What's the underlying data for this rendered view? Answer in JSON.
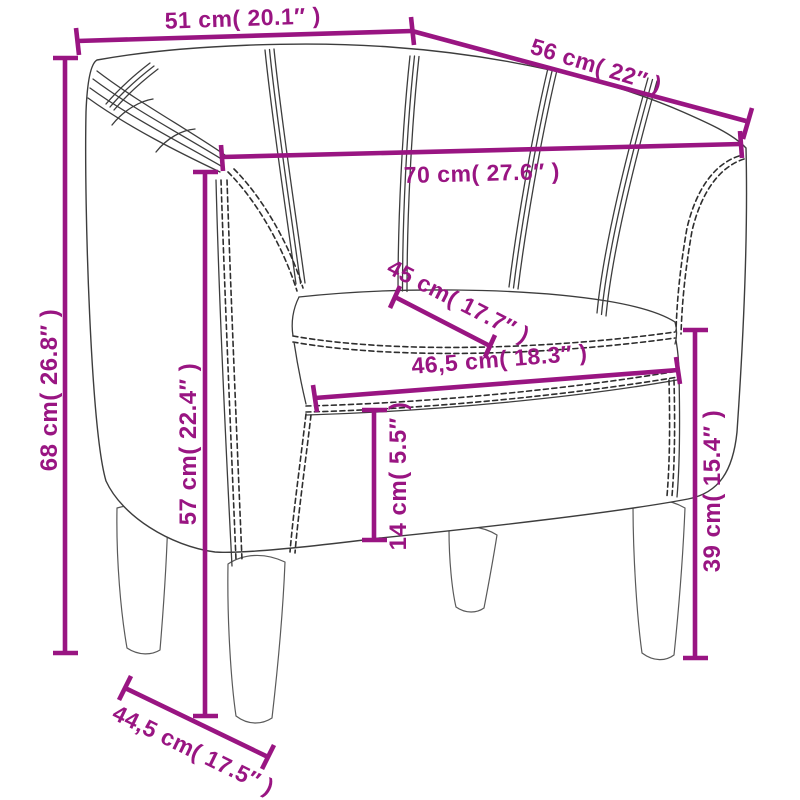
{
  "diagram": {
    "subject": "tub chair dimension diagram",
    "type": "furniture-dimension-line-drawing",
    "colors": {
      "dimension_accent": "#991582",
      "outline": "#3d3d3d",
      "background": "#ffffff"
    },
    "measurements": [
      {
        "id": "back-top-width",
        "cm": "51",
        "inches": "20.1",
        "label": "51 cm( 20.1″ )"
      },
      {
        "id": "back-top-depth",
        "cm": "56",
        "inches": "22",
        "label": "56 cm( 22″ )"
      },
      {
        "id": "overall-width",
        "cm": "70",
        "inches": "27.6",
        "label": "70 cm( 27.6″ )"
      },
      {
        "id": "overall-height",
        "cm": "68",
        "inches": "26.8",
        "label": "68 cm( 26.8″ )"
      },
      {
        "id": "armrest-height",
        "cm": "57",
        "inches": "22.4",
        "label": "57 cm( 22.4″ )"
      },
      {
        "id": "seat-depth",
        "cm": "45",
        "inches": "17.7",
        "label": "45 cm( 17.7″ )"
      },
      {
        "id": "seat-width",
        "cm": "46,5",
        "inches": "18.3",
        "label": "46,5 cm( 18.3″ )"
      },
      {
        "id": "cushion-thickness",
        "cm": "14",
        "inches": "5.5",
        "label": "14 cm( 5.5″ )"
      },
      {
        "id": "seat-height",
        "cm": "39",
        "inches": "15.4",
        "label": "39 cm( 15.4″ )"
      },
      {
        "id": "base-depth",
        "cm": "44,5",
        "inches": "17.5",
        "label": "44,5 cm( 17.5″ )"
      }
    ]
  }
}
